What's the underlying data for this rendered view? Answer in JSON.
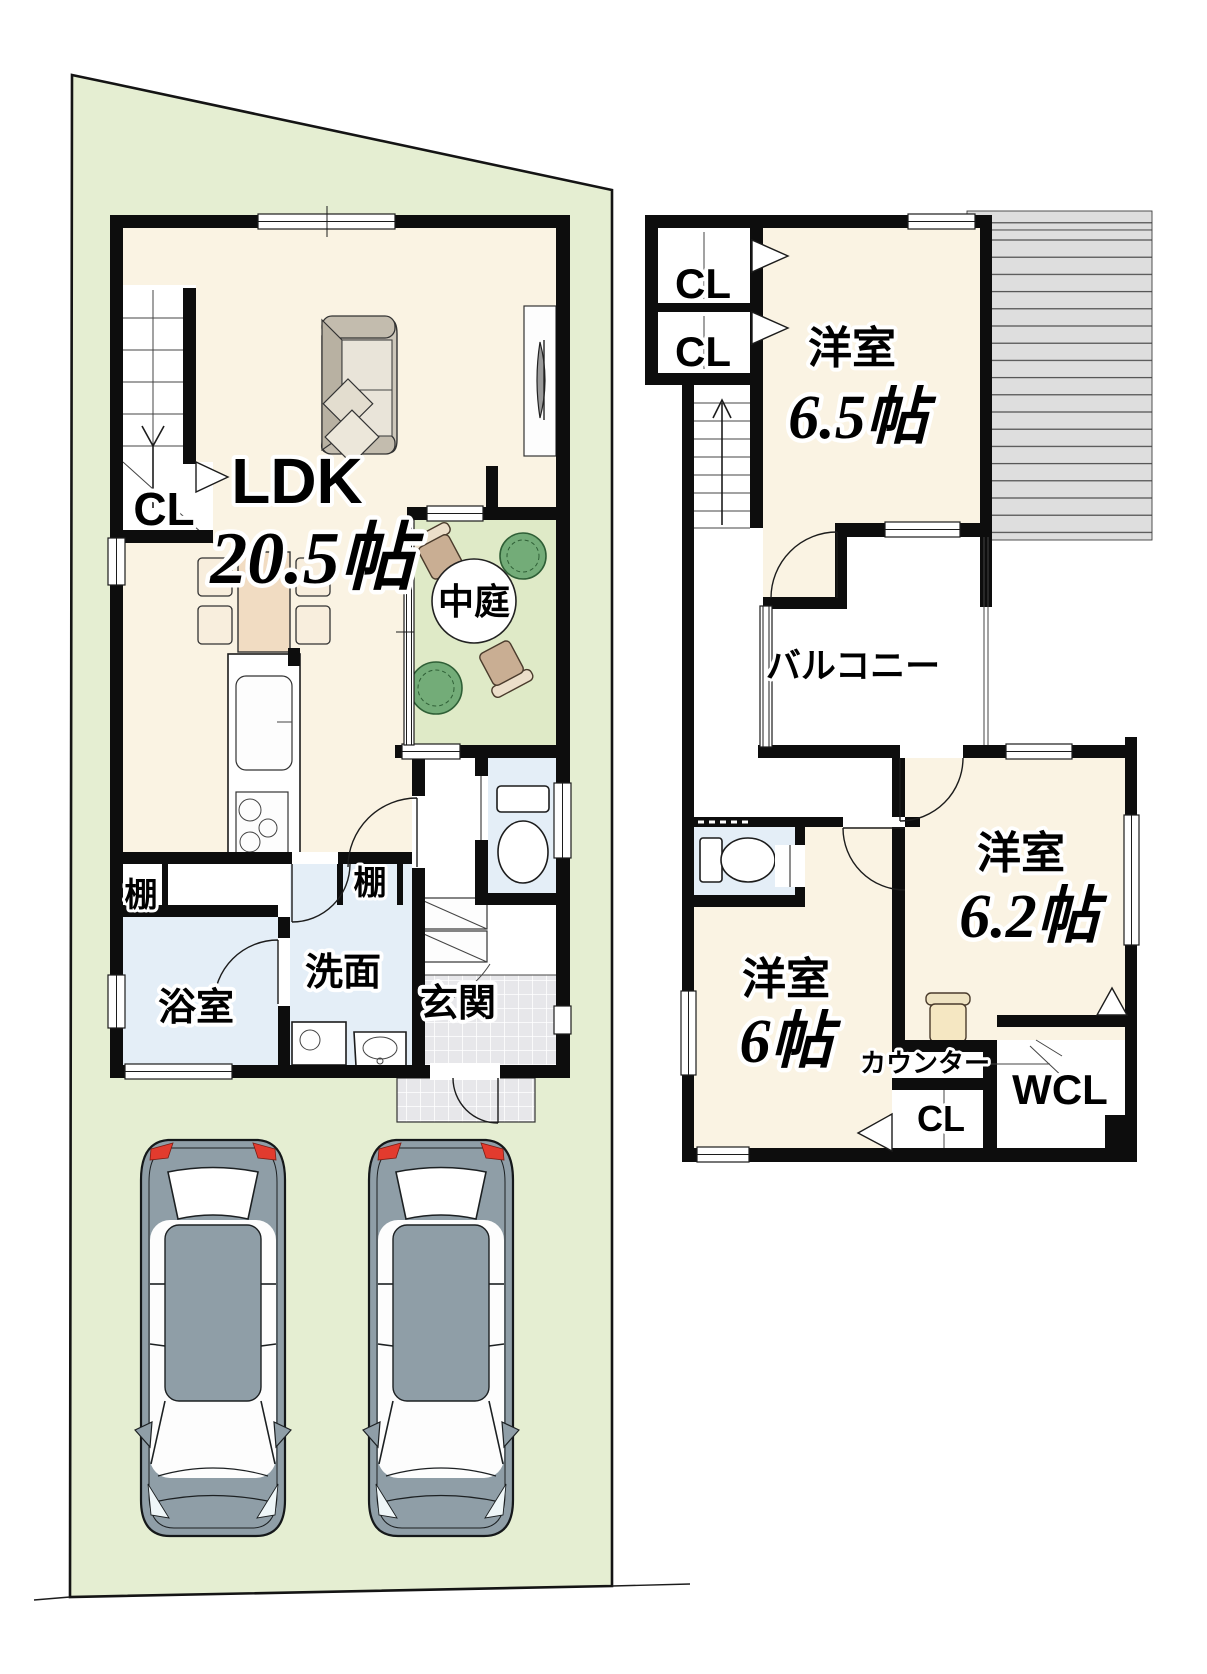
{
  "floor1": {
    "ldk": "LDK",
    "ldk_size": "20.5帖",
    "closet": "CL",
    "courtyard": "中庭",
    "shelf_left": "棚",
    "shelf_right": "棚",
    "bathroom": "浴室",
    "washroom": "洗面",
    "entrance": "玄関"
  },
  "floor2": {
    "closet1": "CL",
    "closet2": "CL",
    "room1": "洋室",
    "room1_size": "6.5帖",
    "balcony": "バルコニー",
    "room2": "洋室",
    "room2_size": "6帖",
    "room3": "洋室",
    "room3_size": "6.2帖",
    "counter": "カウンター",
    "closet3": "CL",
    "walkin": "WCL"
  },
  "colors": {
    "site_green": "#e5eed2",
    "courtyard_green": "#dfeac7",
    "room_cream": "#faf3e3",
    "water_blue": "#e4eef7",
    "tile_gray": "#e7e7ea",
    "roof_gray": "#dedede",
    "wall_black": "#0d0d0d",
    "car_gray": "#8f9ea7",
    "accent_red": "#e23b2e",
    "wood_tan": "#f1dcc2",
    "chair_cream": "#f8eedd",
    "counter_chair": "#f5e7c2",
    "bush_green": "#73ac78",
    "sofa_gray": "#cdc7ba",
    "garden_chair": "#c9ae93"
  }
}
